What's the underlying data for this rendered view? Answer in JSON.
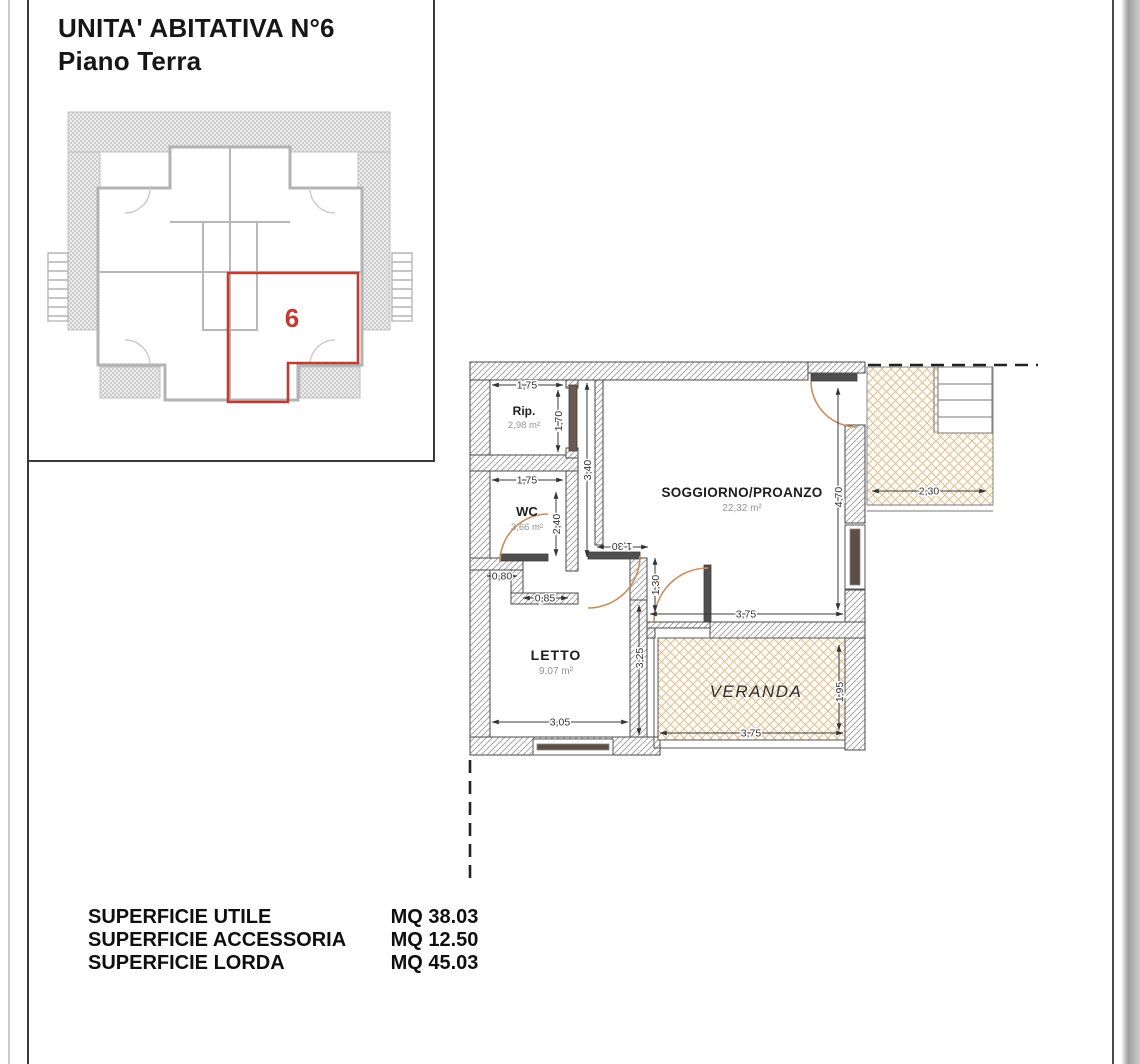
{
  "page": {
    "title_line1": "UNITA' ABITATIVA N°6",
    "title_line2": "Piano Terra"
  },
  "key_plan": {
    "unit_number": "6"
  },
  "plan": {
    "rooms": {
      "rip": {
        "name": "Rip.",
        "area": "2,98 m²"
      },
      "wc": {
        "name": "WC",
        "area": "3,66 m²"
      },
      "soggiorno": {
        "name": "SOGGIORNO/PROANZO",
        "area": "22,32 m²"
      },
      "letto": {
        "name": "LETTO",
        "area": "9,07 m²"
      },
      "veranda": {
        "name": "VERANDA"
      }
    },
    "dims": {
      "rip_w": "1,75",
      "rip_h": "1,70",
      "wall_left": "3,40",
      "wc_w": "1,75",
      "wc_h": "2,40",
      "niche_a": "0,80",
      "niche_b": "0,85",
      "hall_w": "1,30",
      "hall_h": "1,30",
      "letto_h": "3,25",
      "letto_w": "3,05",
      "sogg_w": "3,75",
      "sogg_h": "4,70",
      "veranda_w": "3,75",
      "veranda_h": "1,95",
      "terrace_w": "2,30"
    }
  },
  "summary": {
    "rows": [
      {
        "label": "SUPERFICIE UTILE",
        "value": "MQ 38.03"
      },
      {
        "label": "SUPERFICIE ACCESSORIA",
        "value": "MQ 12.50"
      },
      {
        "label": "SUPERFICIE LORDA",
        "value": "MQ 45.03"
      }
    ]
  },
  "colors": {
    "unit_highlight": "#c23b33",
    "wall_hatch": "#9b9b9b",
    "veranda_hatch": "#dfc096",
    "door_arc": "#c98e5f"
  }
}
